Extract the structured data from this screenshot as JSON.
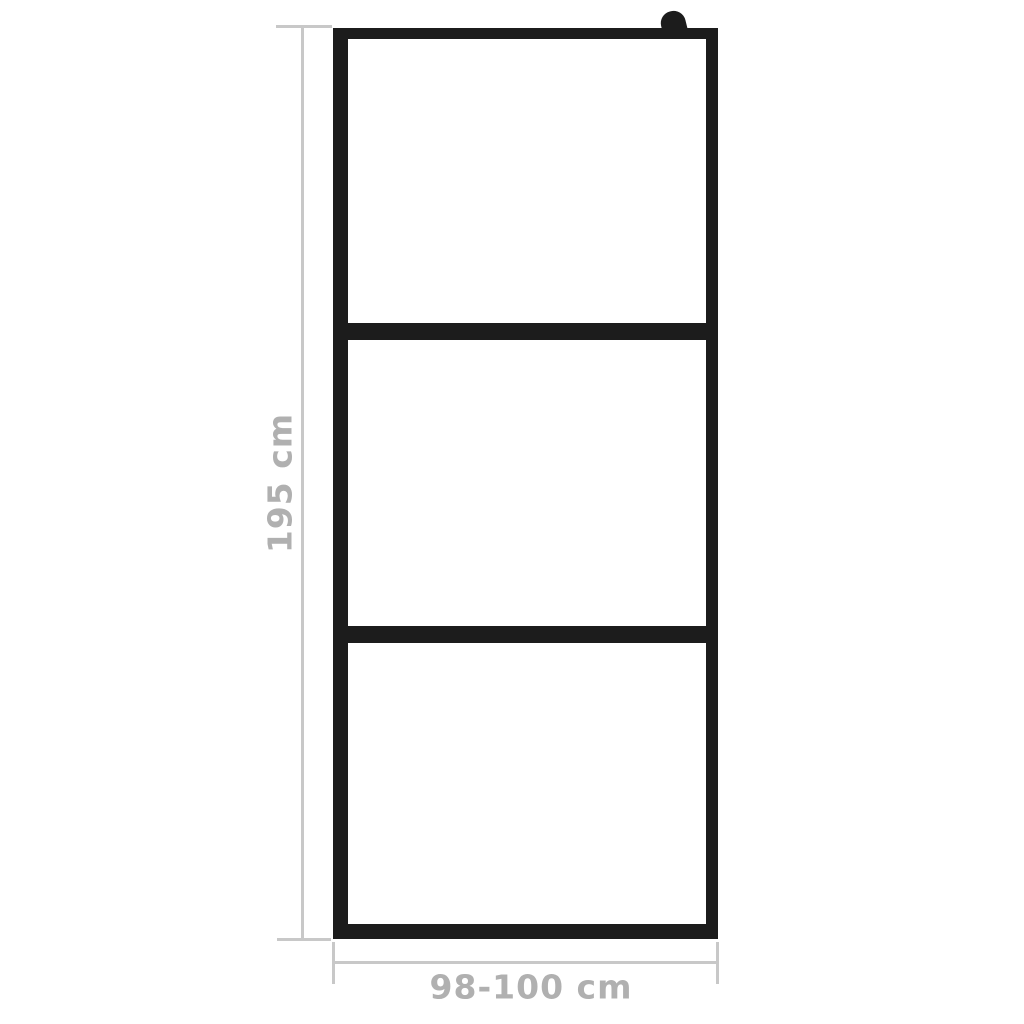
{
  "diagram": {
    "kind": "product-dimension-diagram",
    "subject": "black-framed walk-in shower glass screen with three glass sections and wall-bracket knob",
    "panel_count": 3,
    "labels": {
      "height": "195 cm",
      "width": "98-100 cm"
    }
  },
  "colors": {
    "background": "#ffffff",
    "frame-black": "#1c1c1c",
    "dim-line": "#c8c8c8",
    "dim-text": "#b0b0b0"
  }
}
